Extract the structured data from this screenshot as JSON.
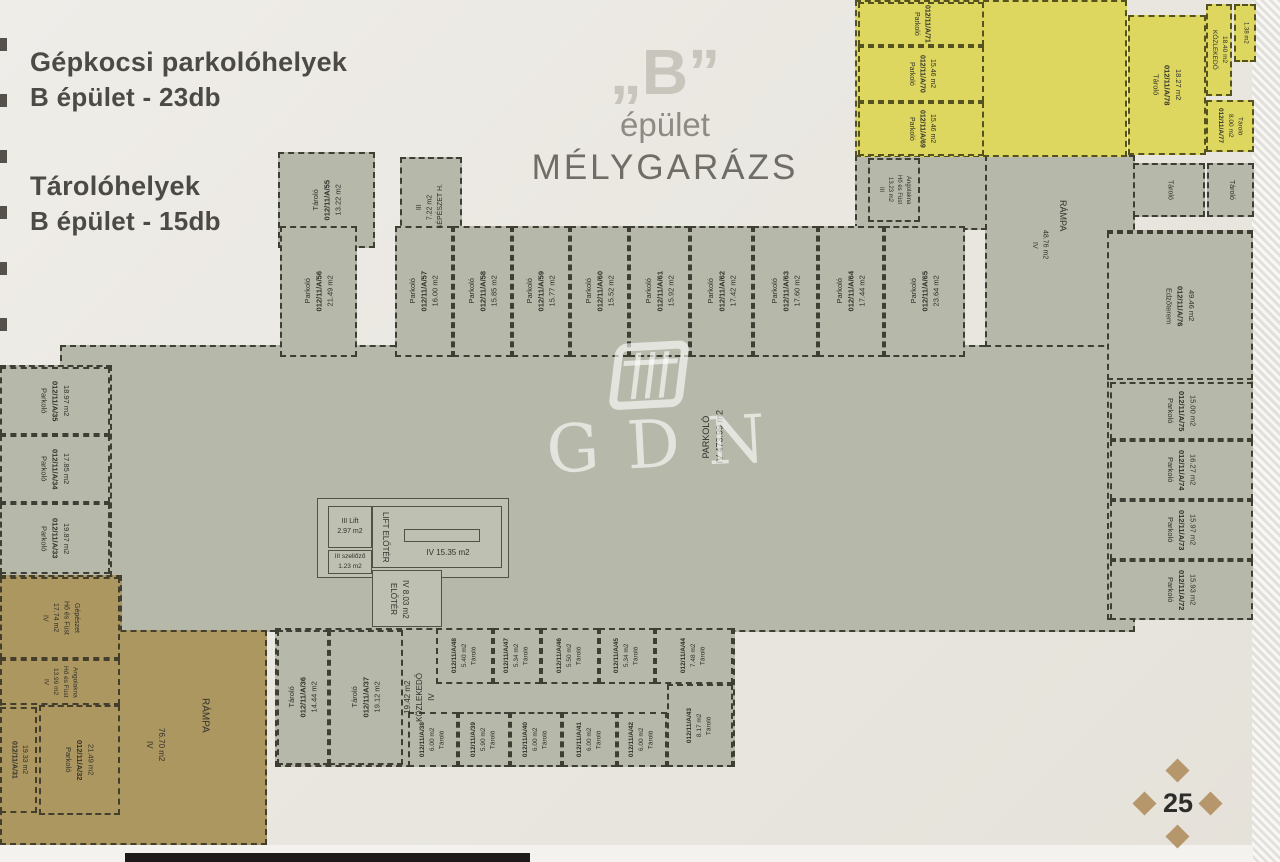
{
  "legend": {
    "parking_title": "Gépkocsi parkolóhelyek",
    "parking_count": "B épület - 23db",
    "storage_title": "Tárolóhelyek",
    "storage_count": "B épület - 15db"
  },
  "title": {
    "building_letter": "„B”",
    "line2": "épület",
    "line3": "MÉLYGARÁZS"
  },
  "watermark": {
    "text": "GDN"
  },
  "page": {
    "number": "25"
  },
  "colors": {
    "floor_gray": "#b6b8a9",
    "zone_yellow": "#ddd75f",
    "zone_tan": "#ad9760",
    "wall_dash": "#3f3e35",
    "paper": "#ebe8e2",
    "diamond_tan": "#b5976b"
  },
  "plan": {
    "slabs": [
      {
        "x": 60,
        "y": 345,
        "w": 1075,
        "h": 287,
        "c": "gray"
      },
      {
        "x": 0,
        "y": 365,
        "w": 112,
        "h": 212,
        "c": "gray"
      },
      {
        "x": 985,
        "y": 155,
        "w": 150,
        "h": 192,
        "c": "gray"
      },
      {
        "x": 855,
        "y": 155,
        "w": 132,
        "h": 75,
        "c": "gray"
      },
      {
        "x": 1107,
        "y": 230,
        "w": 146,
        "h": 390,
        "c": "gray"
      },
      {
        "x": 855,
        "y": 0,
        "w": 272,
        "h": 157,
        "c": "yellow"
      },
      {
        "x": 0,
        "y": 575,
        "w": 122,
        "h": 270,
        "c": "tan"
      },
      {
        "x": 0,
        "y": 630,
        "w": 267,
        "h": 215,
        "c": "tan"
      },
      {
        "x": 275,
        "y": 628,
        "w": 460,
        "h": 139,
        "c": "gray"
      }
    ],
    "rooms": [
      {
        "id": "a55",
        "ls": [
          "Tároló",
          "012/11/A/55",
          "13.22 m2"
        ],
        "x": 278,
        "y": 152,
        "w": 97,
        "h": 96,
        "c": "gray",
        "rot": "ccw"
      },
      {
        "id": "gepeszet",
        "ls": [
          "III",
          "7.22 m2",
          "GÉPÉSZET H."
        ],
        "x": 400,
        "y": 157,
        "w": 62,
        "h": 100,
        "c": "gray",
        "rot": "ccw",
        "fs": 7
      },
      {
        "id": "a56",
        "ls": [
          "Parkoló",
          "012/11/A/56",
          "21.49 m2"
        ],
        "x": 280,
        "y": 226,
        "w": 77,
        "h": 131,
        "c": "gray",
        "rot": "ccw"
      },
      {
        "id": "a57",
        "ls": [
          "Parkoló",
          "012/11/A/57",
          "16.00 m2"
        ],
        "x": 395,
        "y": 226,
        "w": 58,
        "h": 131,
        "c": "gray",
        "rot": "ccw"
      },
      {
        "id": "a58",
        "ls": [
          "Parkoló",
          "012/11/A/58",
          "15.85 m2"
        ],
        "x": 453,
        "y": 226,
        "w": 59,
        "h": 131,
        "c": "gray",
        "rot": "ccw"
      },
      {
        "id": "a59",
        "ls": [
          "Parkoló",
          "012/11/A/59",
          "15.77 m2"
        ],
        "x": 512,
        "y": 226,
        "w": 58,
        "h": 131,
        "c": "gray",
        "rot": "ccw"
      },
      {
        "id": "a60",
        "ls": [
          "Parkoló",
          "012/11/A/60",
          "15.52 m2"
        ],
        "x": 570,
        "y": 226,
        "w": 59,
        "h": 131,
        "c": "gray",
        "rot": "ccw"
      },
      {
        "id": "a61",
        "ls": [
          "Parkoló",
          "012/11/A/61",
          "15.92 m2"
        ],
        "x": 629,
        "y": 226,
        "w": 61,
        "h": 131,
        "c": "gray",
        "rot": "ccw"
      },
      {
        "id": "a62",
        "ls": [
          "Parkoló",
          "012/11/A/62",
          "17.42 m2"
        ],
        "x": 690,
        "y": 226,
        "w": 63,
        "h": 131,
        "c": "gray",
        "rot": "ccw"
      },
      {
        "id": "a63",
        "ls": [
          "Parkoló",
          "012/11/A/63",
          "17.60 m2"
        ],
        "x": 753,
        "y": 226,
        "w": 65,
        "h": 131,
        "c": "gray",
        "rot": "ccw"
      },
      {
        "id": "a64",
        "ls": [
          "Parkoló",
          "012/11/A/64",
          "17.44 m2"
        ],
        "x": 818,
        "y": 226,
        "w": 66,
        "h": 131,
        "c": "gray",
        "rot": "ccw"
      },
      {
        "id": "a65",
        "ls": [
          "Parkoló",
          "012/11/A/65",
          "23.64 m2"
        ],
        "x": 884,
        "y": 226,
        "w": 81,
        "h": 131,
        "c": "gray",
        "rot": "ccw"
      },
      {
        "id": "a35",
        "ls": [
          "Parkoló",
          "012/11/A/35",
          "18.97 m2"
        ],
        "x": 0,
        "y": 367,
        "w": 110,
        "h": 68,
        "c": "gray",
        "rot": "cw"
      },
      {
        "id": "a34",
        "ls": [
          "Parkoló",
          "012/11/A/34",
          "17.85 m2"
        ],
        "x": 0,
        "y": 435,
        "w": 110,
        "h": 68,
        "c": "gray",
        "rot": "cw"
      },
      {
        "id": "a33",
        "ls": [
          "Parkoló",
          "012/11/A/33",
          "19.87 m2"
        ],
        "x": 0,
        "y": 503,
        "w": 110,
        "h": 71,
        "c": "gray",
        "rot": "cw"
      },
      {
        "id": "hofust-gepeszet",
        "ls": [
          "IV",
          "17.74 m2",
          "Hő és Füst",
          "Gépészet"
        ],
        "x": 0,
        "y": 577,
        "w": 120,
        "h": 82,
        "c": "tan",
        "rot": "cw",
        "fs": 7
      },
      {
        "id": "hofust-angolakna-sw",
        "ls": [
          "IV",
          "13.99 m2",
          "Hő és Füst",
          "Angolakna"
        ],
        "x": 0,
        "y": 659,
        "w": 120,
        "h": 46,
        "c": "tan",
        "rot": "cw",
        "fs": 6.5
      },
      {
        "id": "a31",
        "ls": [
          "012/11/A/31",
          "19.33 m2"
        ],
        "x": 0,
        "y": 707,
        "w": 37,
        "h": 106,
        "c": "tan",
        "rot": "cw",
        "fs": 7
      },
      {
        "id": "a32",
        "ls": [
          "Parkoló",
          "012/11/A/32",
          "21.49 m2"
        ],
        "x": 39,
        "y": 705,
        "w": 81,
        "h": 110,
        "c": "tan",
        "rot": "cw"
      },
      {
        "id": "a36",
        "ls": [
          "Tároló",
          "012/11/A/36",
          "14.44 m2"
        ],
        "x": 277,
        "y": 630,
        "w": 52,
        "h": 135,
        "c": "gray",
        "rot": "ccw"
      },
      {
        "id": "a37",
        "ls": [
          "Tároló",
          "012/11/A/37",
          "19.12 m2"
        ],
        "x": 329,
        "y": 630,
        "w": 74,
        "h": 135,
        "c": "gray",
        "rot": "ccw"
      },
      {
        "id": "a48",
        "ls": [
          "012/11/A/48",
          "5.40 m2",
          "Tároló"
        ],
        "x": 436,
        "y": 628,
        "w": 57,
        "h": 56,
        "c": "gray",
        "rot": "ccw",
        "fs": 6.5
      },
      {
        "id": "a47",
        "ls": [
          "012/11/A/47",
          "5.34 m2",
          "Tároló"
        ],
        "x": 493,
        "y": 628,
        "w": 48,
        "h": 56,
        "c": "gray",
        "rot": "ccw",
        "fs": 6.5
      },
      {
        "id": "a46",
        "ls": [
          "012/11/A/46",
          "5.50 m2",
          "Tároló"
        ],
        "x": 541,
        "y": 628,
        "w": 58,
        "h": 56,
        "c": "gray",
        "rot": "ccw",
        "fs": 6.5
      },
      {
        "id": "a45",
        "ls": [
          "012/11/A/45",
          "5.34 m2",
          "Tároló"
        ],
        "x": 599,
        "y": 628,
        "w": 56,
        "h": 56,
        "c": "gray",
        "rot": "ccw",
        "fs": 6.5
      },
      {
        "id": "a44",
        "ls": [
          "012/11/A/44",
          "7.48 m2",
          "Tároló"
        ],
        "x": 655,
        "y": 628,
        "w": 78,
        "h": 56,
        "c": "gray",
        "rot": "ccw",
        "fs": 6.5
      },
      {
        "id": "a38",
        "ls": [
          "012/11/A/38",
          "6.00 m2",
          "Tároló"
        ],
        "x": 408,
        "y": 712,
        "w": 50,
        "h": 55,
        "c": "gray",
        "rot": "ccw",
        "fs": 6.5
      },
      {
        "id": "a39",
        "ls": [
          "012/11/A/39",
          "5.90 m2",
          "Tároló"
        ],
        "x": 458,
        "y": 712,
        "w": 52,
        "h": 55,
        "c": "gray",
        "rot": "ccw",
        "fs": 6.5
      },
      {
        "id": "a40",
        "ls": [
          "012/11/A/40",
          "6.00 m2",
          "Tároló"
        ],
        "x": 510,
        "y": 712,
        "w": 52,
        "h": 55,
        "c": "gray",
        "rot": "ccw",
        "fs": 6.5
      },
      {
        "id": "a41",
        "ls": [
          "012/11/A/41",
          "6.00 m2",
          "Tároló"
        ],
        "x": 562,
        "y": 712,
        "w": 55,
        "h": 55,
        "c": "gray",
        "rot": "ccw",
        "fs": 6.5
      },
      {
        "id": "a42",
        "ls": [
          "012/11/A/42",
          "6.00 m2",
          "Tároló"
        ],
        "x": 617,
        "y": 712,
        "w": 50,
        "h": 55,
        "c": "gray",
        "rot": "ccw",
        "fs": 6.5
      },
      {
        "id": "a43",
        "ls": [
          "012/11/A/43",
          "8.17 m2",
          "Tároló"
        ],
        "x": 667,
        "y": 684,
        "w": 66,
        "h": 83,
        "c": "gray",
        "rot": "ccw",
        "fs": 6.5
      },
      {
        "id": "lift-envelope",
        "ls": [],
        "x": 317,
        "y": 498,
        "w": 192,
        "h": 80,
        "c": "lift",
        "solid": true
      },
      {
        "id": "lift",
        "ls": [
          "III   Lift",
          "2.97 m2"
        ],
        "x": 328,
        "y": 506,
        "w": 44,
        "h": 42,
        "c": "lift",
        "solid": true,
        "rot": "h",
        "fs": 7
      },
      {
        "id": "szellozo",
        "ls": [
          "III szellőző",
          "1.23 m2"
        ],
        "x": 328,
        "y": 550,
        "w": 44,
        "h": 24,
        "c": "lift",
        "solid": true,
        "rot": "h",
        "fs": 6.5
      },
      {
        "id": "lift-eloter-room",
        "ls": [],
        "x": 372,
        "y": 506,
        "w": 130,
        "h": 62,
        "c": "lift",
        "solid": true
      },
      {
        "id": "stair",
        "ls": [],
        "x": 404,
        "y": 529,
        "w": 76,
        "h": 13,
        "c": "none",
        "solid": true
      },
      {
        "id": "eloter-room",
        "ls": [],
        "x": 372,
        "y": 570,
        "w": 70,
        "h": 57,
        "c": "lift",
        "solid": true
      },
      {
        "id": "edzoterem",
        "ls": [
          "Edzőterem",
          "012/11/A/76",
          "49.46 m2"
        ],
        "x": 1107,
        "y": 232,
        "w": 146,
        "h": 148,
        "c": "gray",
        "rot": "cw"
      },
      {
        "id": "a75",
        "ls": [
          "Parkoló",
          "012/11/A/75",
          "15.00 m2"
        ],
        "x": 1110,
        "y": 382,
        "w": 143,
        "h": 58,
        "c": "gray",
        "rot": "cw"
      },
      {
        "id": "a74",
        "ls": [
          "Parkoló",
          "012/11/A/74",
          "16.27 m2"
        ],
        "x": 1110,
        "y": 440,
        "w": 143,
        "h": 60,
        "c": "gray",
        "rot": "cw"
      },
      {
        "id": "a73",
        "ls": [
          "Parkoló",
          "012/11/A/73",
          "15.97 m2"
        ],
        "x": 1110,
        "y": 500,
        "w": 143,
        "h": 60,
        "c": "gray",
        "rot": "cw"
      },
      {
        "id": "a72",
        "ls": [
          "Parkoló",
          "012/11/A/72",
          "15.93 m2"
        ],
        "x": 1110,
        "y": 560,
        "w": 143,
        "h": 60,
        "c": "gray",
        "rot": "cw"
      },
      {
        "id": "hofust-angolakna-ne",
        "ls": [
          "III",
          "13.23 m2",
          "Hő és Füst",
          "Angolakna"
        ],
        "x": 868,
        "y": 158,
        "w": 52,
        "h": 64,
        "c": "gray",
        "rot": "cw",
        "fs": 6
      },
      {
        "id": "y71",
        "ls": [
          "Parkoló",
          "012/11/A/71"
        ],
        "x": 858,
        "y": 2,
        "w": 126,
        "h": 44,
        "c": "yellow",
        "rot": "cw",
        "fs": 7
      },
      {
        "id": "y70",
        "ls": [
          "Parkoló",
          "012/11/A/70",
          "15.46 m2"
        ],
        "x": 858,
        "y": 46,
        "w": 126,
        "h": 56,
        "c": "yellow",
        "rot": "cw",
        "fs": 7
      },
      {
        "id": "y69",
        "ls": [
          "Parkoló",
          "012/11/A/69",
          "15.46 m2"
        ],
        "x": 858,
        "y": 102,
        "w": 126,
        "h": 54,
        "c": "yellow",
        "rot": "cw",
        "fs": 7
      },
      {
        "id": "y78",
        "ls": [
          "Tároló",
          "012/11/A/78",
          "18.27 m2"
        ],
        "x": 1128,
        "y": 15,
        "w": 78,
        "h": 140,
        "c": "yellow",
        "rot": "cw"
      },
      {
        "id": "y-kozlekedo",
        "ls": [
          "KÖZLEKEDŐ",
          "18.40 m2"
        ],
        "x": 1206,
        "y": 4,
        "w": 26,
        "h": 92,
        "c": "yellow",
        "rot": "cw",
        "fs": 6.5
      },
      {
        "id": "y-small",
        "ls": [
          "1.38 m2"
        ],
        "x": 1234,
        "y": 4,
        "w": 22,
        "h": 58,
        "c": "yellow",
        "rot": "cw",
        "fs": 6
      },
      {
        "id": "y77",
        "ls": [
          "012/11/A/77",
          "8.00 m2",
          "Tároló"
        ],
        "x": 1206,
        "y": 100,
        "w": 48,
        "h": 52,
        "c": "yellow",
        "rot": "cw",
        "fs": 6.5
      },
      {
        "id": "tarolo-ne1",
        "ls": [
          "Tároló"
        ],
        "x": 1133,
        "y": 163,
        "w": 72,
        "h": 54,
        "c": "gray",
        "rot": "cw",
        "fs": 7
      },
      {
        "id": "tarolo-ne2",
        "ls": [
          "Tároló"
        ],
        "x": 1207,
        "y": 163,
        "w": 47,
        "h": 54,
        "c": "gray",
        "rot": "cw",
        "fs": 7
      }
    ],
    "labels": [
      {
        "id": "parkolo-main",
        "ls": [
          "PARKOLÓ",
          "IV   473.99 m2"
        ],
        "x": 690,
        "y": 378,
        "w": 46,
        "h": 118,
        "rot": "ccw",
        "fs": 9
      },
      {
        "id": "kozlekedo",
        "ls": [
          "19.42 m2",
          "KÖZLEKEDŐ",
          "IV"
        ],
        "x": 404,
        "y": 632,
        "w": 32,
        "h": 130,
        "rot": "ccw",
        "fs": 8
      },
      {
        "id": "rampa-sw",
        "ls": [
          "RÁMPA"
        ],
        "x": 192,
        "y": 678,
        "w": 26,
        "h": 74,
        "rot": "cw",
        "fs": 10
      },
      {
        "id": "rampa-sw-area",
        "ls": [
          "IV",
          "76.70 m2"
        ],
        "x": 140,
        "y": 714,
        "w": 30,
        "h": 62,
        "rot": "cw",
        "fs": 8
      },
      {
        "id": "rampa-ne",
        "ls": [
          "RÁMPA"
        ],
        "x": 1050,
        "y": 172,
        "w": 24,
        "h": 88,
        "rot": "cw",
        "fs": 9
      },
      {
        "id": "rampa-ne-area",
        "ls": [
          "IV",
          "48.76 m2"
        ],
        "x": 1026,
        "y": 214,
        "w": 26,
        "h": 62,
        "rot": "cw",
        "fs": 7
      },
      {
        "id": "lift-eloter-name",
        "ls": [
          "LIFT ELŐTÉR"
        ],
        "x": 376,
        "y": 508,
        "w": 18,
        "h": 58,
        "rot": "cw",
        "fs": 8
      },
      {
        "id": "lift-eloter-area",
        "ls": [
          "IV    15.35 m2"
        ],
        "x": 408,
        "y": 546,
        "w": 80,
        "h": 14,
        "rot": "h",
        "fs": 8
      },
      {
        "id": "eloter",
        "ls": [
          "ELŐTÉR",
          "IV  8.03 m2"
        ],
        "x": 382,
        "y": 574,
        "w": 34,
        "h": 50,
        "rot": "cw",
        "fs": 8
      }
    ]
  }
}
